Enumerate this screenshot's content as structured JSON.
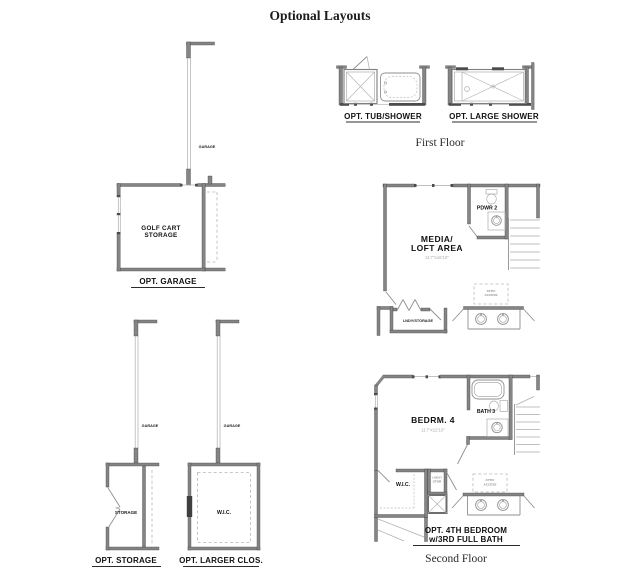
{
  "title": "Optional Layouts",
  "colors": {
    "background": "#ffffff",
    "wall": "#858585",
    "wall_dark": "#4c4c4c",
    "fixture_line": "#8f8f8f",
    "dashed_line": "#b6b6b6",
    "text": "#111111",
    "dim_text": "#ababab"
  },
  "first_floor": {
    "caption": "First Floor",
    "tub_shower_label": "OPT. TUB/SHOWER",
    "large_shower_label": "OPT. LARGE SHOWER"
  },
  "garage_opt": {
    "label": "OPT. GARAGE",
    "wall_label": "GARAGE",
    "room_line1": "GOLF CART",
    "room_line2": "STORAGE"
  },
  "storage_opt": {
    "label": "OPT. STORAGE",
    "wall_label": "GARAGE",
    "room": "STORAGE"
  },
  "larger_closet_opt": {
    "label": "OPT. LARGER CLOS.",
    "wall_label": "GARAGE",
    "room": "W.I.C."
  },
  "second_floor": {
    "caption": "Second Floor",
    "media_loft": {
      "room_line1": "MEDIA/",
      "room_line2": "LOFT AREA",
      "dims": "11'7\"x16'10\"",
      "powder_label": "PDWR 2",
      "laundry_label": "LNDY/STORAGE",
      "attic_line1": "ATTIC",
      "attic_line2": "ACCESS"
    },
    "bedroom4": {
      "label_line1": "OPT. 4TH BEDROOM",
      "label_line2": "w/3RD FULL BATH",
      "room": "BEDRM. 4",
      "dims": "11'7\"x12'10\"",
      "bath_label": "BATH 3",
      "wic_label": "W.I.C.",
      "laundry_line1": "LNDY/",
      "laundry_line2": "STOR",
      "attic_line1": "ATTIC",
      "attic_line2": "ACCESS"
    }
  }
}
